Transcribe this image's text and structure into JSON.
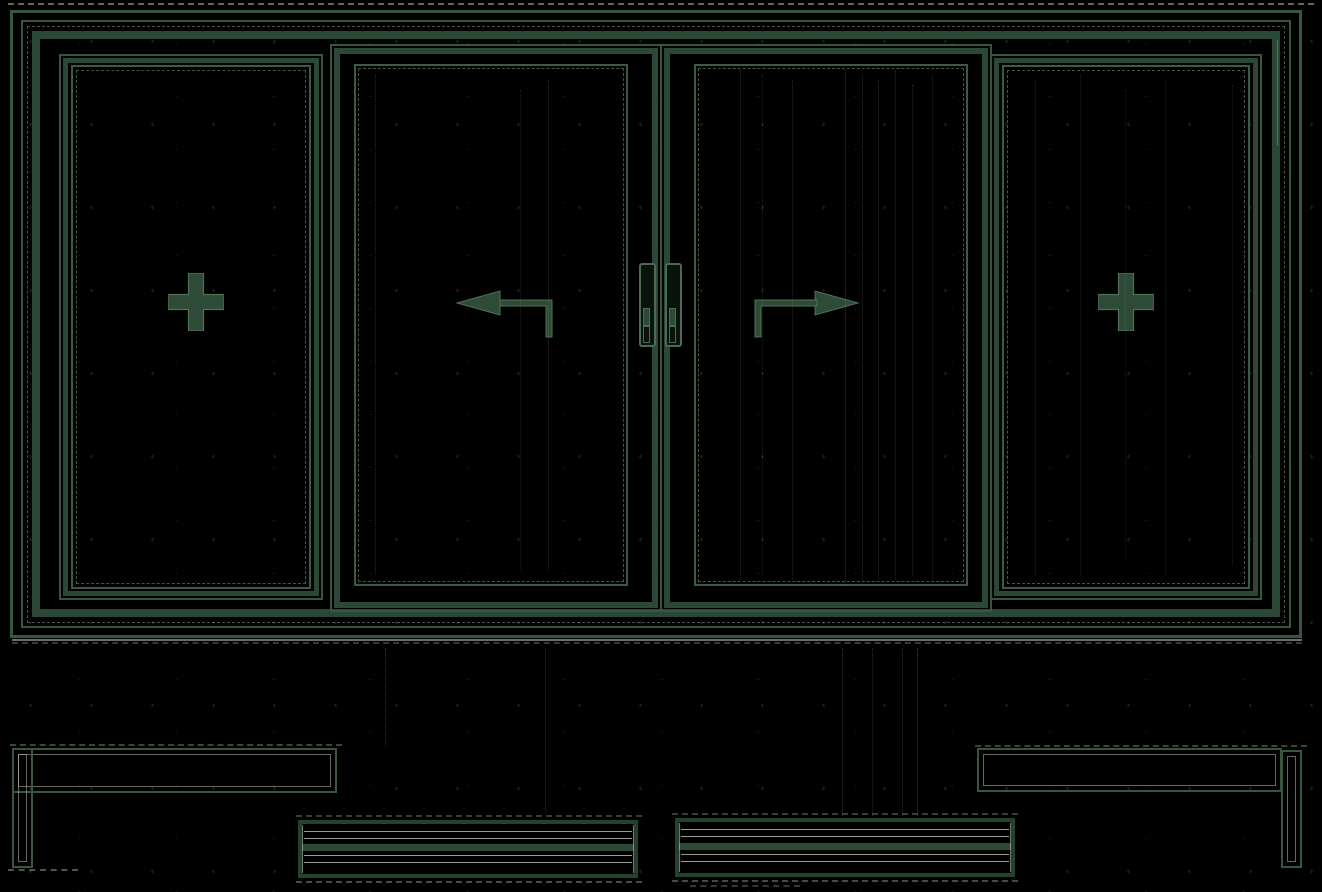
{
  "drawing": {
    "type": "cad-elevation",
    "title": "Four-panel sliding window — elevation with section details",
    "colors": {
      "background": "#000000",
      "line": "#35573f",
      "band": "#2a4835",
      "symbol_fill": "#2d4b37",
      "symbol_edge": "#507056",
      "noise": "#c4cdbf"
    },
    "frame": {
      "label": "outer window frame"
    },
    "panels": [
      {
        "label": "fixed panel (left)",
        "symbol": "plus-icon"
      },
      {
        "label": "sliding sash (slides left)",
        "symbol": "arrow-left-icon"
      },
      {
        "label": "sliding sash (slides right)",
        "symbol": "arrow-right-icon"
      },
      {
        "label": "fixed panel (right)",
        "symbol": "plus-icon"
      }
    ],
    "hardware": [
      {
        "label": "meeting-stile handle (left sash)"
      },
      {
        "label": "meeting-stile handle (right sash)"
      }
    ],
    "details": [
      {
        "label": "jamb/sill section profile (bottom left)"
      },
      {
        "label": "jamb/sill section profile (bottom right)"
      },
      {
        "label": "track section detail (bottom left-center)"
      },
      {
        "label": "track section detail (bottom right-center)"
      }
    ]
  }
}
